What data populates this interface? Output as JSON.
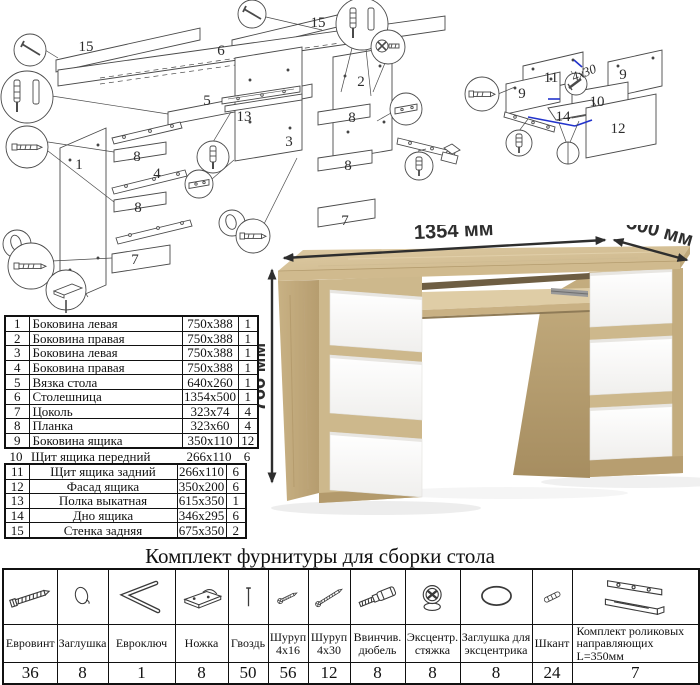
{
  "diagram_main": {
    "labels": [
      "15",
      "15",
      "6",
      "5",
      "2",
      "13",
      "3",
      "8",
      "8",
      "7",
      "1",
      "8",
      "4",
      "8",
      "7"
    ]
  },
  "diagram_drawer": {
    "labels": [
      "11",
      "9",
      "9",
      "10",
      "14",
      "12"
    ],
    "annotation": "4х30",
    "accent_color": "#2233cc"
  },
  "desk": {
    "dim_width": "1354 мм",
    "dim_depth": "500 мм",
    "dim_height": "766 мм",
    "colors": {
      "oak_top": "#d9c69c",
      "oak_side": "#c4ad7e",
      "drawer_white": "#fbfbfb"
    }
  },
  "parts_table": {
    "rows": [
      {
        "num": "1",
        "name": "Боковина левая",
        "size": "750x388",
        "qty": "1"
      },
      {
        "num": "2",
        "name": "Боковина правая",
        "size": "750x388",
        "qty": "1"
      },
      {
        "num": "3",
        "name": "Боковина левая",
        "size": "750x388",
        "qty": "1"
      },
      {
        "num": "4",
        "name": "Боковина правая",
        "size": "750x388",
        "qty": "1"
      },
      {
        "num": "5",
        "name": "Вязка стола",
        "size": "640x260",
        "qty": "1"
      },
      {
        "num": "6",
        "name": "Столешница",
        "size": "1354x500",
        "qty": "1"
      },
      {
        "num": "7",
        "name": "Цоколь",
        "size": "323x74",
        "qty": "4"
      },
      {
        "num": "8",
        "name": "Планка",
        "size": "323x60",
        "qty": "4"
      },
      {
        "num": "9",
        "name": "Боковина ящика",
        "size": "350x110",
        "qty": "12"
      },
      {
        "num": "10",
        "name": "Щит ящика передний",
        "size": "266x110",
        "qty": "6"
      },
      {
        "num": "11",
        "name": "Щит ящика задний",
        "size": "266x110",
        "qty": "6"
      },
      {
        "num": "12",
        "name": "Фасад ящика",
        "size": "350x200",
        "qty": "6"
      },
      {
        "num": "13",
        "name": "Полка выкатная",
        "size": "615x350",
        "qty": "1"
      },
      {
        "num": "14",
        "name": "Дно ящика",
        "size": "346x295",
        "qty": "6"
      },
      {
        "num": "15",
        "name": "Стенка задняя",
        "size": "675x350",
        "qty": "2"
      }
    ]
  },
  "hardware": {
    "title": "Комплект фурнитуры для сборки стола",
    "items": [
      {
        "icon": "euroscrew",
        "name": "Евровинт",
        "qty": "36"
      },
      {
        "icon": "cap",
        "name": "Заглушка",
        "qty": "8"
      },
      {
        "icon": "hexkey",
        "name": "Евроключ",
        "qty": "1"
      },
      {
        "icon": "foot",
        "name": "Ножка",
        "qty": "8"
      },
      {
        "icon": "nail",
        "name": "Гвоздь",
        "qty": "50"
      },
      {
        "icon": "screw16",
        "name": "Шуруп 4x16",
        "qty": "56"
      },
      {
        "icon": "screw30",
        "name": "Шуруп 4x30",
        "qty": "12"
      },
      {
        "icon": "dowelscrew",
        "name": "Ввинчив. дюбель",
        "qty": "8"
      },
      {
        "icon": "camlock",
        "name": "Эксцентр. стяжка",
        "qty": "8"
      },
      {
        "icon": "camcap",
        "name": "Заглушка для эксцентрика",
        "qty": "8"
      },
      {
        "icon": "shkant",
        "name": "Шкант",
        "qty": "24"
      },
      {
        "icon": "slides",
        "name": "Комплект роликовых направляющих L=350мм",
        "qty": "7"
      }
    ]
  }
}
